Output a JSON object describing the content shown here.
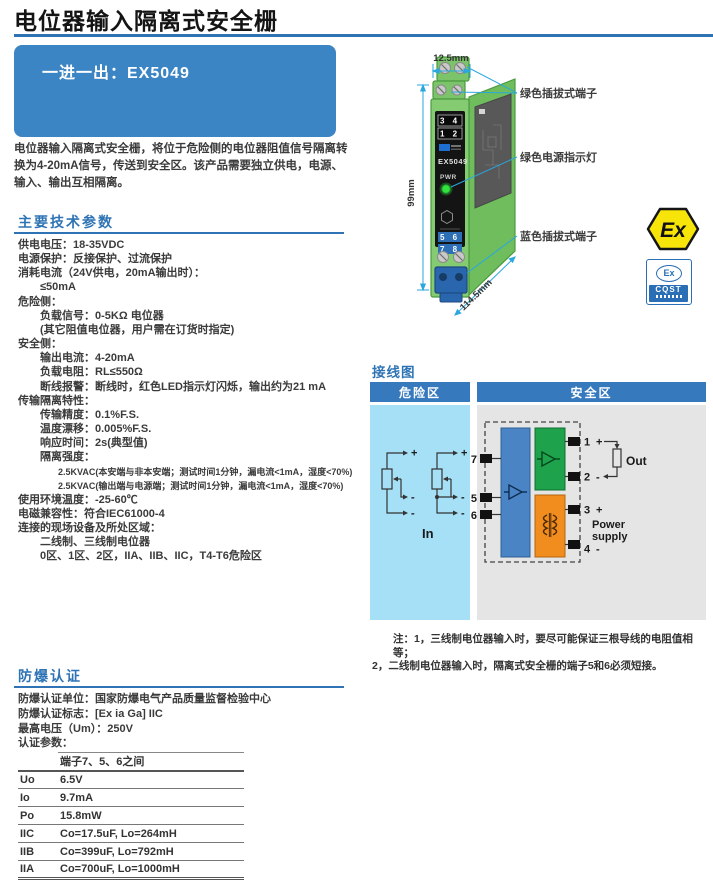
{
  "header": {
    "title": "电位器输入隔离式安全栅"
  },
  "banner": {
    "label": "一进一出：EX5049"
  },
  "intro": {
    "description": "电位器输入隔离式安全栅，将位于危险侧的电位器阻值信号隔离转换为4-20mA信号，传送到安全区。该产品需要独立供电，电源、输入、输出互相隔离。"
  },
  "tech": {
    "heading": "主要技术参数",
    "lines": [
      {
        "text": "供电电压：18-35VDC",
        "level": "lv0"
      },
      {
        "text": "电源保护：反接保护、过流保护",
        "level": "lv0"
      },
      {
        "text": "消耗电流（24V供电，20mA输出时）：",
        "level": "lv0"
      },
      {
        "text": "≤50mA",
        "level": "lv1"
      },
      {
        "text": "危险侧：",
        "level": "lv0"
      },
      {
        "text": "负载信号：0-5KΩ 电位器",
        "level": "lv1"
      },
      {
        "text": "(其它阻值电位器，用户需在订货时指定)",
        "level": "lv1"
      },
      {
        "text": "安全侧：",
        "level": "lv0"
      },
      {
        "text": "输出电流：4-20mA",
        "level": "lv1"
      },
      {
        "text": "负载电阻：RL≤550Ω",
        "level": "lv1"
      },
      {
        "text": "断线报警：断线时，红色LED指示灯闪烁，输出约为21 mA",
        "level": "lv1"
      },
      {
        "text": "传输隔离特性：",
        "level": "lv0"
      },
      {
        "text": "传输精度：0.1%F.S.",
        "level": "lv1"
      },
      {
        "text": "温度漂移：0.005%F.S.",
        "level": "lv1"
      },
      {
        "text": "响应时间：2s(典型值)",
        "level": "lv1"
      },
      {
        "text": "隔离强度：",
        "level": "lv1"
      },
      {
        "text": "2.5KVAC(本安端与非本安端；测试时间1分钟，漏电流<1mA，湿度<70%)",
        "level": "lv2"
      },
      {
        "text": "2.5KVAC(输出端与电源端；测试时间1分钟，漏电流<1mA，湿度<70%)",
        "level": "lv2"
      },
      {
        "text": "使用环境温度：-25-60℃",
        "level": "lv0"
      },
      {
        "text": "电磁兼容性：符合IEC61000-4",
        "level": "lv0"
      },
      {
        "text": "连接的现场设备及所处区域：",
        "level": "lv0"
      },
      {
        "text": "二线制、三线制电位器",
        "level": "lv1"
      },
      {
        "text": "0区、1区、2区，IIA、IIB、IIC，T4-T6危险区",
        "level": "lv1"
      }
    ]
  },
  "figure": {
    "dim_width": "12.5mm",
    "dim_height": "99mm",
    "dim_depth": "114.5mm",
    "callout_green_terminal": "绿色插拔式端子",
    "callout_power_led": "绿色电源指示灯",
    "callout_blue_terminal": "蓝色插拔式端子",
    "panel": {
      "row_34": "3 4",
      "row_12": "1 2",
      "model": "EX5049",
      "pwr": "PWR",
      "row_56": "5 6",
      "row_78": "7 8"
    },
    "logos": {
      "atex": "Ex",
      "cqst_ex": "Ex",
      "cqst_name": "CQST"
    }
  },
  "wiring": {
    "heading": "接线图",
    "zones": {
      "hazard": "危险区",
      "safe": "安全区"
    },
    "in_label": "In",
    "out_label": "Out",
    "power_line1": "Power",
    "power_line2": "supply",
    "terminals": {
      "t7": "7",
      "t5": "5",
      "t6": "6",
      "t1": "1",
      "t2": "2",
      "t3": "3",
      "t4": "4"
    },
    "signs": {
      "plus": "+",
      "minus": "-"
    },
    "notes": [
      "注：1，三线制电位器输入时，要尽可能保证三根导线的电阻值相等；",
      "2，二线制电位器输入时，隔离式安全栅的端子5和6必须短接。"
    ]
  },
  "cert": {
    "heading": "防爆认证",
    "lines": [
      "防爆认证单位：国家防爆电气产品质量监督检验中心",
      "防爆认证标志：[Ex ia Ga] IIC",
      "最高电压（Um）：250V",
      "认证参数："
    ],
    "table": {
      "header": [
        "",
        "端子7、5、6之间"
      ],
      "rows": [
        [
          "Uo",
          "6.5V"
        ],
        [
          "Io",
          "9.7mA"
        ],
        [
          "Po",
          "15.8mW"
        ],
        [
          "IIC",
          "Co=17.5uF, Lo=264mH"
        ],
        [
          "IIB",
          "Co=399uF, Lo=792mH"
        ],
        [
          "IIA",
          "Co=700uF, Lo=1000mH"
        ]
      ]
    }
  }
}
